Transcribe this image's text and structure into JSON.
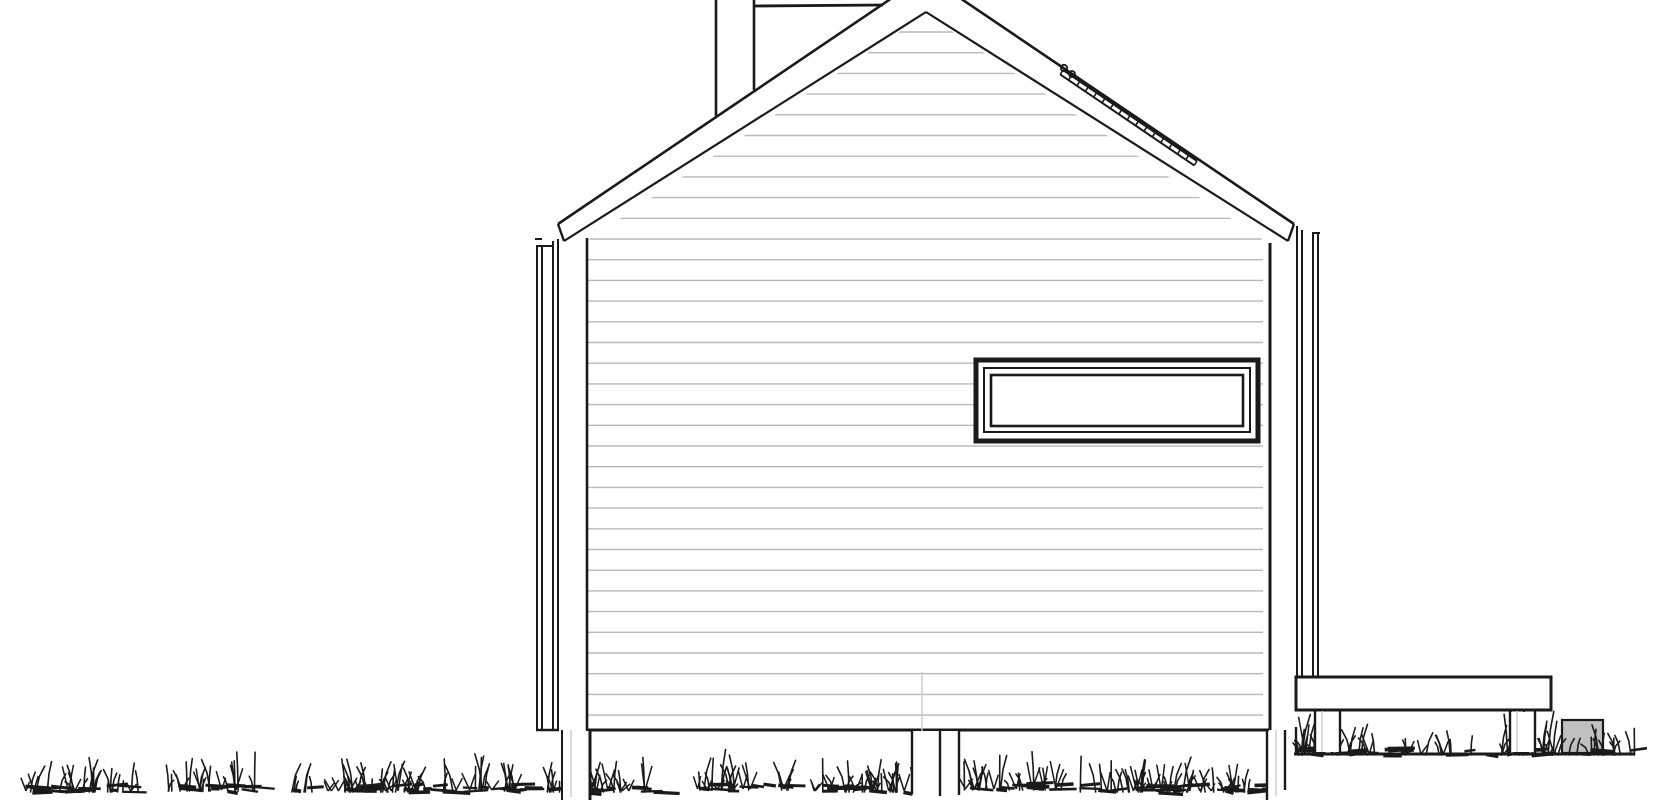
{
  "meta": {
    "document_type": "architectural side elevation line drawing",
    "canvas": {
      "width": 1670,
      "height": 800
    },
    "background": "#ffffff"
  },
  "palette": {
    "ink": "#1a1a1a",
    "siding_line": "#b9b9b9",
    "faint_line": "#c9c9c9",
    "block_fill": "#c0c0c0",
    "white": "#ffffff"
  },
  "drawing": {
    "render_order": [
      "siding",
      "wall",
      "window",
      "roof",
      "chimney",
      "roof_rail",
      "corner_trim_left",
      "corner_trim_right",
      "deck",
      "terrain",
      "grass",
      "foundation_posts"
    ],
    "groups": {
      "siding": {
        "siding": {
          "x1": 588,
          "x2": 1263,
          "yStart": 32,
          "step": 20.7,
          "count": 34,
          "w": 1.4,
          "colorKey": "siding_line",
          "clip": [
            [
              588,
              731
            ],
            [
              588,
              240
            ],
            [
              926,
              14
            ],
            [
              1263,
              240
            ],
            [
              1263,
              731
            ]
          ]
        }
      },
      "wall": {
        "lines": [
          {
            "x1": 587,
            "y1": 238,
            "x2": 587,
            "y2": 730,
            "w": 2.6
          },
          {
            "x1": 1270,
            "y1": 243,
            "x2": 1270,
            "y2": 730,
            "w": 3
          },
          {
            "x1": 586,
            "y1": 730,
            "x2": 1269,
            "y2": 730,
            "w": 3
          },
          {
            "x1": 922,
            "y1": 672,
            "x2": 922,
            "y2": 789,
            "w": 1.4,
            "colorKey": "faint_line"
          }
        ]
      },
      "window": {
        "rects": [
          {
            "x": 976,
            "y": 360,
            "w": 282,
            "h": 81,
            "sw": 5,
            "fill": "#ffffff"
          },
          {
            "x": 984,
            "y": 368,
            "w": 266,
            "h": 64,
            "sw": 2
          },
          {
            "x": 991,
            "y": 375,
            "w": 252,
            "h": 51,
            "sw": 2.6
          }
        ]
      },
      "roof": {
        "polygons": [
          {
            "points": [
              [
                558,
                224
              ],
              [
                926,
                -25
              ],
              [
                1294,
                224
              ],
              [
                1288,
                241
              ],
              [
                926,
                12
              ],
              [
                564,
                241
              ]
            ],
            "fill": "#ffffff",
            "sw": 0
          }
        ],
        "lines": [
          {
            "x1": 558,
            "y1": 224,
            "x2": 926,
            "y2": -25,
            "w": 2.6
          },
          {
            "x1": 926,
            "y1": -25,
            "x2": 1294,
            "y2": 224,
            "w": 2.6
          },
          {
            "x1": 558,
            "y1": 224,
            "x2": 564,
            "y2": 241,
            "w": 2.4
          },
          {
            "x1": 1294,
            "y1": 224,
            "x2": 1288,
            "y2": 241,
            "w": 2.4
          },
          {
            "x1": 564,
            "y1": 241,
            "x2": 926,
            "y2": 12,
            "w": 2.2
          },
          {
            "x1": 926,
            "y1": 12,
            "x2": 1288,
            "y2": 241,
            "w": 2.2
          }
        ]
      },
      "chimney": {
        "lines": [
          {
            "x1": 716,
            "y1": -2,
            "x2": 716,
            "y2": 116,
            "w": 2.6
          },
          {
            "x1": 754,
            "y1": -2,
            "x2": 754,
            "y2": 90,
            "w": 2.6
          },
          {
            "x1": 753,
            "y1": 6,
            "x2": 883,
            "y2": 5,
            "w": 2.8
          }
        ]
      },
      "roof_rail": {
        "ladders": [
          {
            "x1": 1063,
            "y1": 70,
            "x2": 1197,
            "y2": 161,
            "ox": -2.8,
            "oy": 4.4,
            "ticks": 17,
            "w": 2
          }
        ],
        "circles": [
          {
            "cx": 1064,
            "cy": 68,
            "r": 3.2,
            "sw": 1.8
          },
          {
            "cx": 1072,
            "cy": 74,
            "r": 3.0,
            "sw": 1.8
          }
        ]
      },
      "corner_trim_left": {
        "lines": [
          {
            "x1": 537,
            "y1": 246,
            "x2": 537,
            "y2": 730,
            "w": 2
          },
          {
            "x1": 542,
            "y1": 246,
            "x2": 542,
            "y2": 730,
            "w": 2
          },
          {
            "x1": 553,
            "y1": 241,
            "x2": 553,
            "y2": 730,
            "w": 2
          },
          {
            "x1": 558,
            "y1": 239,
            "x2": 558,
            "y2": 730,
            "w": 2
          },
          {
            "x1": 535,
            "y1": 239,
            "x2": 542,
            "y2": 239,
            "w": 2
          },
          {
            "x1": 536,
            "y1": 246,
            "x2": 554,
            "y2": 246,
            "w": 2
          },
          {
            "x1": 536,
            "y1": 730,
            "x2": 559,
            "y2": 730,
            "w": 2.4
          }
        ]
      },
      "corner_trim_right": {
        "lines": [
          {
            "x1": 1297,
            "y1": 226,
            "x2": 1297,
            "y2": 677,
            "w": 2
          },
          {
            "x1": 1302,
            "y1": 230,
            "x2": 1302,
            "y2": 677,
            "w": 2
          },
          {
            "x1": 1313,
            "y1": 233,
            "x2": 1313,
            "y2": 677,
            "w": 2
          },
          {
            "x1": 1318,
            "y1": 233,
            "x2": 1318,
            "y2": 677,
            "w": 2
          },
          {
            "x1": 1312,
            "y1": 233,
            "x2": 1320,
            "y2": 233,
            "w": 2
          }
        ]
      },
      "deck": {
        "rects": [
          {
            "x": 1296,
            "y": 677,
            "w": 255,
            "h": 33,
            "sw": 3,
            "fill": "#ffffff"
          }
        ],
        "lines": [
          {
            "x1": 1296,
            "y1": 727,
            "x2": 1296,
            "y2": 753,
            "w": 2.4
          }
        ]
      },
      "terrain": {
        "rects": [
          {
            "x": 1562,
            "y": 720,
            "w": 41,
            "h": 33,
            "sw": 2.2,
            "fillKey": "block_fill"
          }
        ],
        "lines": [
          {
            "x1": 1294,
            "y1": 754,
            "x2": 1634,
            "y2": 754,
            "w": 3
          }
        ]
      },
      "grass": {
        "clusters": [
          {
            "x": 25,
            "w": 115,
            "base": 789,
            "h": 26,
            "n": 42,
            "seed": 11
          },
          {
            "x": 168,
            "w": 95,
            "base": 788,
            "h": 30,
            "n": 34,
            "seed": 22
          },
          {
            "x": 283,
            "w": 150,
            "base": 789,
            "h": 26,
            "n": 56,
            "seed": 33
          },
          {
            "x": 440,
            "w": 85,
            "base": 788,
            "h": 30,
            "n": 30,
            "seed": 44
          },
          {
            "x": 543,
            "w": 120,
            "base": 789,
            "h": 27,
            "n": 45,
            "seed": 55
          },
          {
            "x": 695,
            "w": 95,
            "base": 787,
            "h": 32,
            "n": 34,
            "seed": 66
          },
          {
            "x": 813,
            "w": 132,
            "base": 789,
            "h": 26,
            "n": 50,
            "seed": 77
          },
          {
            "x": 963,
            "w": 98,
            "base": 787,
            "h": 32,
            "n": 35,
            "seed": 88
          },
          {
            "x": 1078,
            "w": 112,
            "base": 789,
            "h": 27,
            "n": 44,
            "seed": 99
          },
          {
            "x": 1198,
            "w": 66,
            "base": 789,
            "h": 24,
            "n": 24,
            "seed": 12
          },
          {
            "x": 1298,
            "w": 28,
            "base": 752,
            "h": 38,
            "n": 16,
            "seed": 13
          },
          {
            "x": 1332,
            "w": 95,
            "base": 752,
            "h": 24,
            "n": 28,
            "seed": 14
          },
          {
            "x": 1438,
            "w": 55,
            "base": 752,
            "h": 16,
            "n": 10,
            "seed": 15
          },
          {
            "x": 1496,
            "w": 66,
            "base": 752,
            "h": 38,
            "n": 30,
            "seed": 16
          },
          {
            "x": 1565,
            "w": 42,
            "base": 752,
            "h": 30,
            "n": 12,
            "seed": 17
          },
          {
            "x": 1610,
            "w": 26,
            "base": 752,
            "h": 20,
            "n": 8,
            "seed": 18
          }
        ]
      },
      "foundation_posts": {
        "rects": [
          {
            "x": 563,
            "y": 731,
            "w": 26,
            "h": 69,
            "sw": 0,
            "fill": "#ffffff"
          },
          {
            "x": 913,
            "y": 731,
            "w": 45,
            "h": 62,
            "sw": 0,
            "fill": "#ffffff"
          },
          {
            "x": 1268,
            "y": 731,
            "w": 16,
            "h": 69,
            "sw": 0,
            "fill": "#ffffff"
          },
          {
            "x": 1316,
            "y": 712,
            "w": 23,
            "h": 40,
            "sw": 0,
            "fill": "#ffffff"
          },
          {
            "x": 1511,
            "y": 712,
            "w": 23,
            "h": 40,
            "sw": 0,
            "fill": "#ffffff"
          }
        ],
        "lines": [
          {
            "x1": 562,
            "y1": 730,
            "x2": 562,
            "y2": 800,
            "w": 2
          },
          {
            "x1": 590,
            "y1": 730,
            "x2": 590,
            "y2": 800,
            "w": 3
          },
          {
            "x1": 571,
            "y1": 730,
            "x2": 571,
            "y2": 797,
            "w": 1.4,
            "colorKey": "faint_line"
          },
          {
            "x1": 912,
            "y1": 730,
            "x2": 912,
            "y2": 794,
            "w": 2.4
          },
          {
            "x1": 940,
            "y1": 730,
            "x2": 940,
            "y2": 796,
            "w": 2.4
          },
          {
            "x1": 959,
            "y1": 730,
            "x2": 959,
            "y2": 795,
            "w": 2.4
          },
          {
            "x1": 1267,
            "y1": 730,
            "x2": 1267,
            "y2": 800,
            "w": 2.4
          },
          {
            "x1": 1285,
            "y1": 730,
            "x2": 1285,
            "y2": 790,
            "w": 2.4
          },
          {
            "x1": 1276,
            "y1": 730,
            "x2": 1276,
            "y2": 796,
            "w": 1.4,
            "colorKey": "faint_line"
          },
          {
            "x1": 1315,
            "y1": 711,
            "x2": 1315,
            "y2": 753,
            "w": 2.4
          },
          {
            "x1": 1340,
            "y1": 711,
            "x2": 1340,
            "y2": 753,
            "w": 2.4
          },
          {
            "x1": 1322,
            "y1": 711,
            "x2": 1322,
            "y2": 752,
            "w": 1.4,
            "colorKey": "faint_line"
          },
          {
            "x1": 1510,
            "y1": 711,
            "x2": 1510,
            "y2": 753,
            "w": 2.4
          },
          {
            "x1": 1535,
            "y1": 711,
            "x2": 1535,
            "y2": 753,
            "w": 2.4
          },
          {
            "x1": 1517,
            "y1": 711,
            "x2": 1517,
            "y2": 752,
            "w": 1.4,
            "colorKey": "faint_line"
          }
        ]
      }
    }
  }
}
